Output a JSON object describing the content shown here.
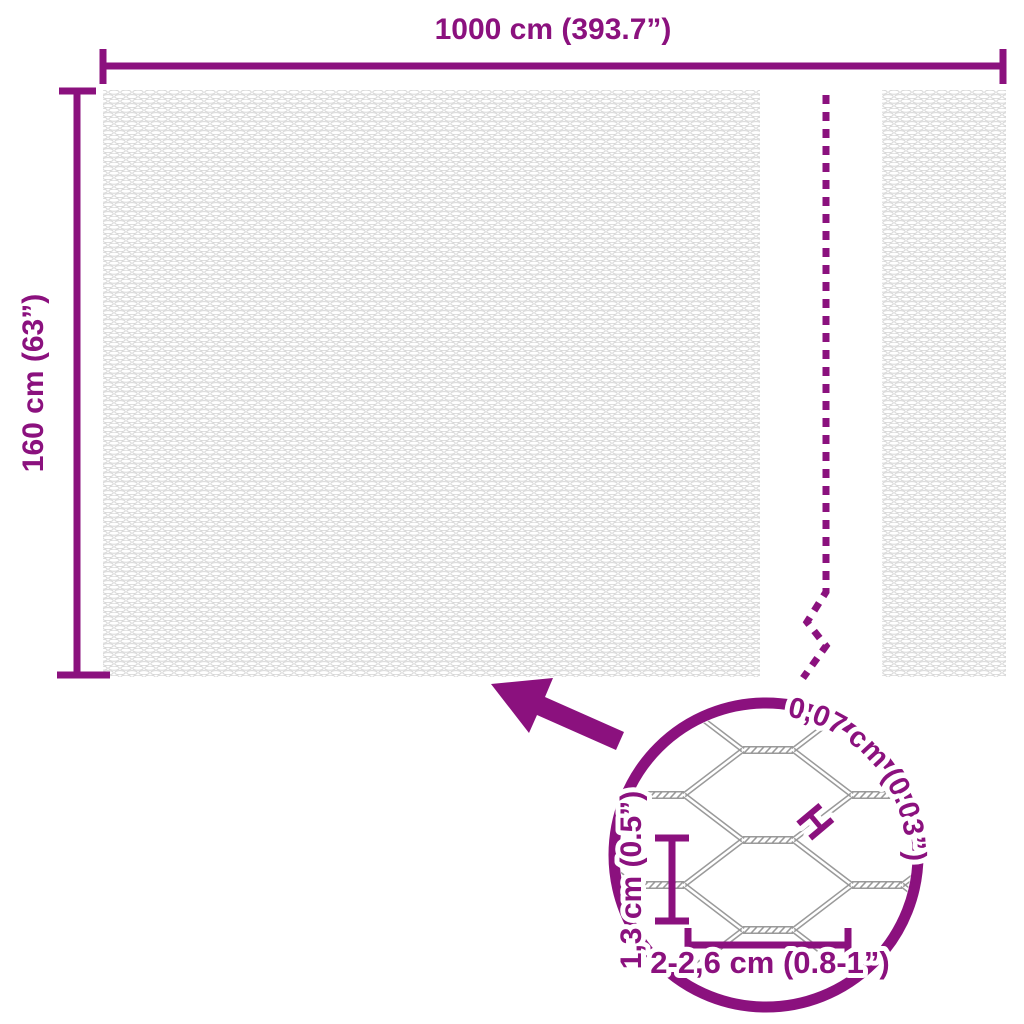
{
  "diagram": {
    "overall_width_label": "1000 cm (393.7”)",
    "overall_height_label": "160 cm (63”)",
    "magnifier": {
      "wire_thickness_label": "0,07 cm (0.03”)",
      "wire_thickness_marker": "H",
      "mesh_height_label": "1,3 cm (0.5”)",
      "mesh_width_label": "2-2,6 cm (0.8-1”)"
    },
    "colors": {
      "accent": "#8B117E",
      "fine_mesh": "#D6D6D6",
      "wire": "#9A9A9A"
    }
  }
}
